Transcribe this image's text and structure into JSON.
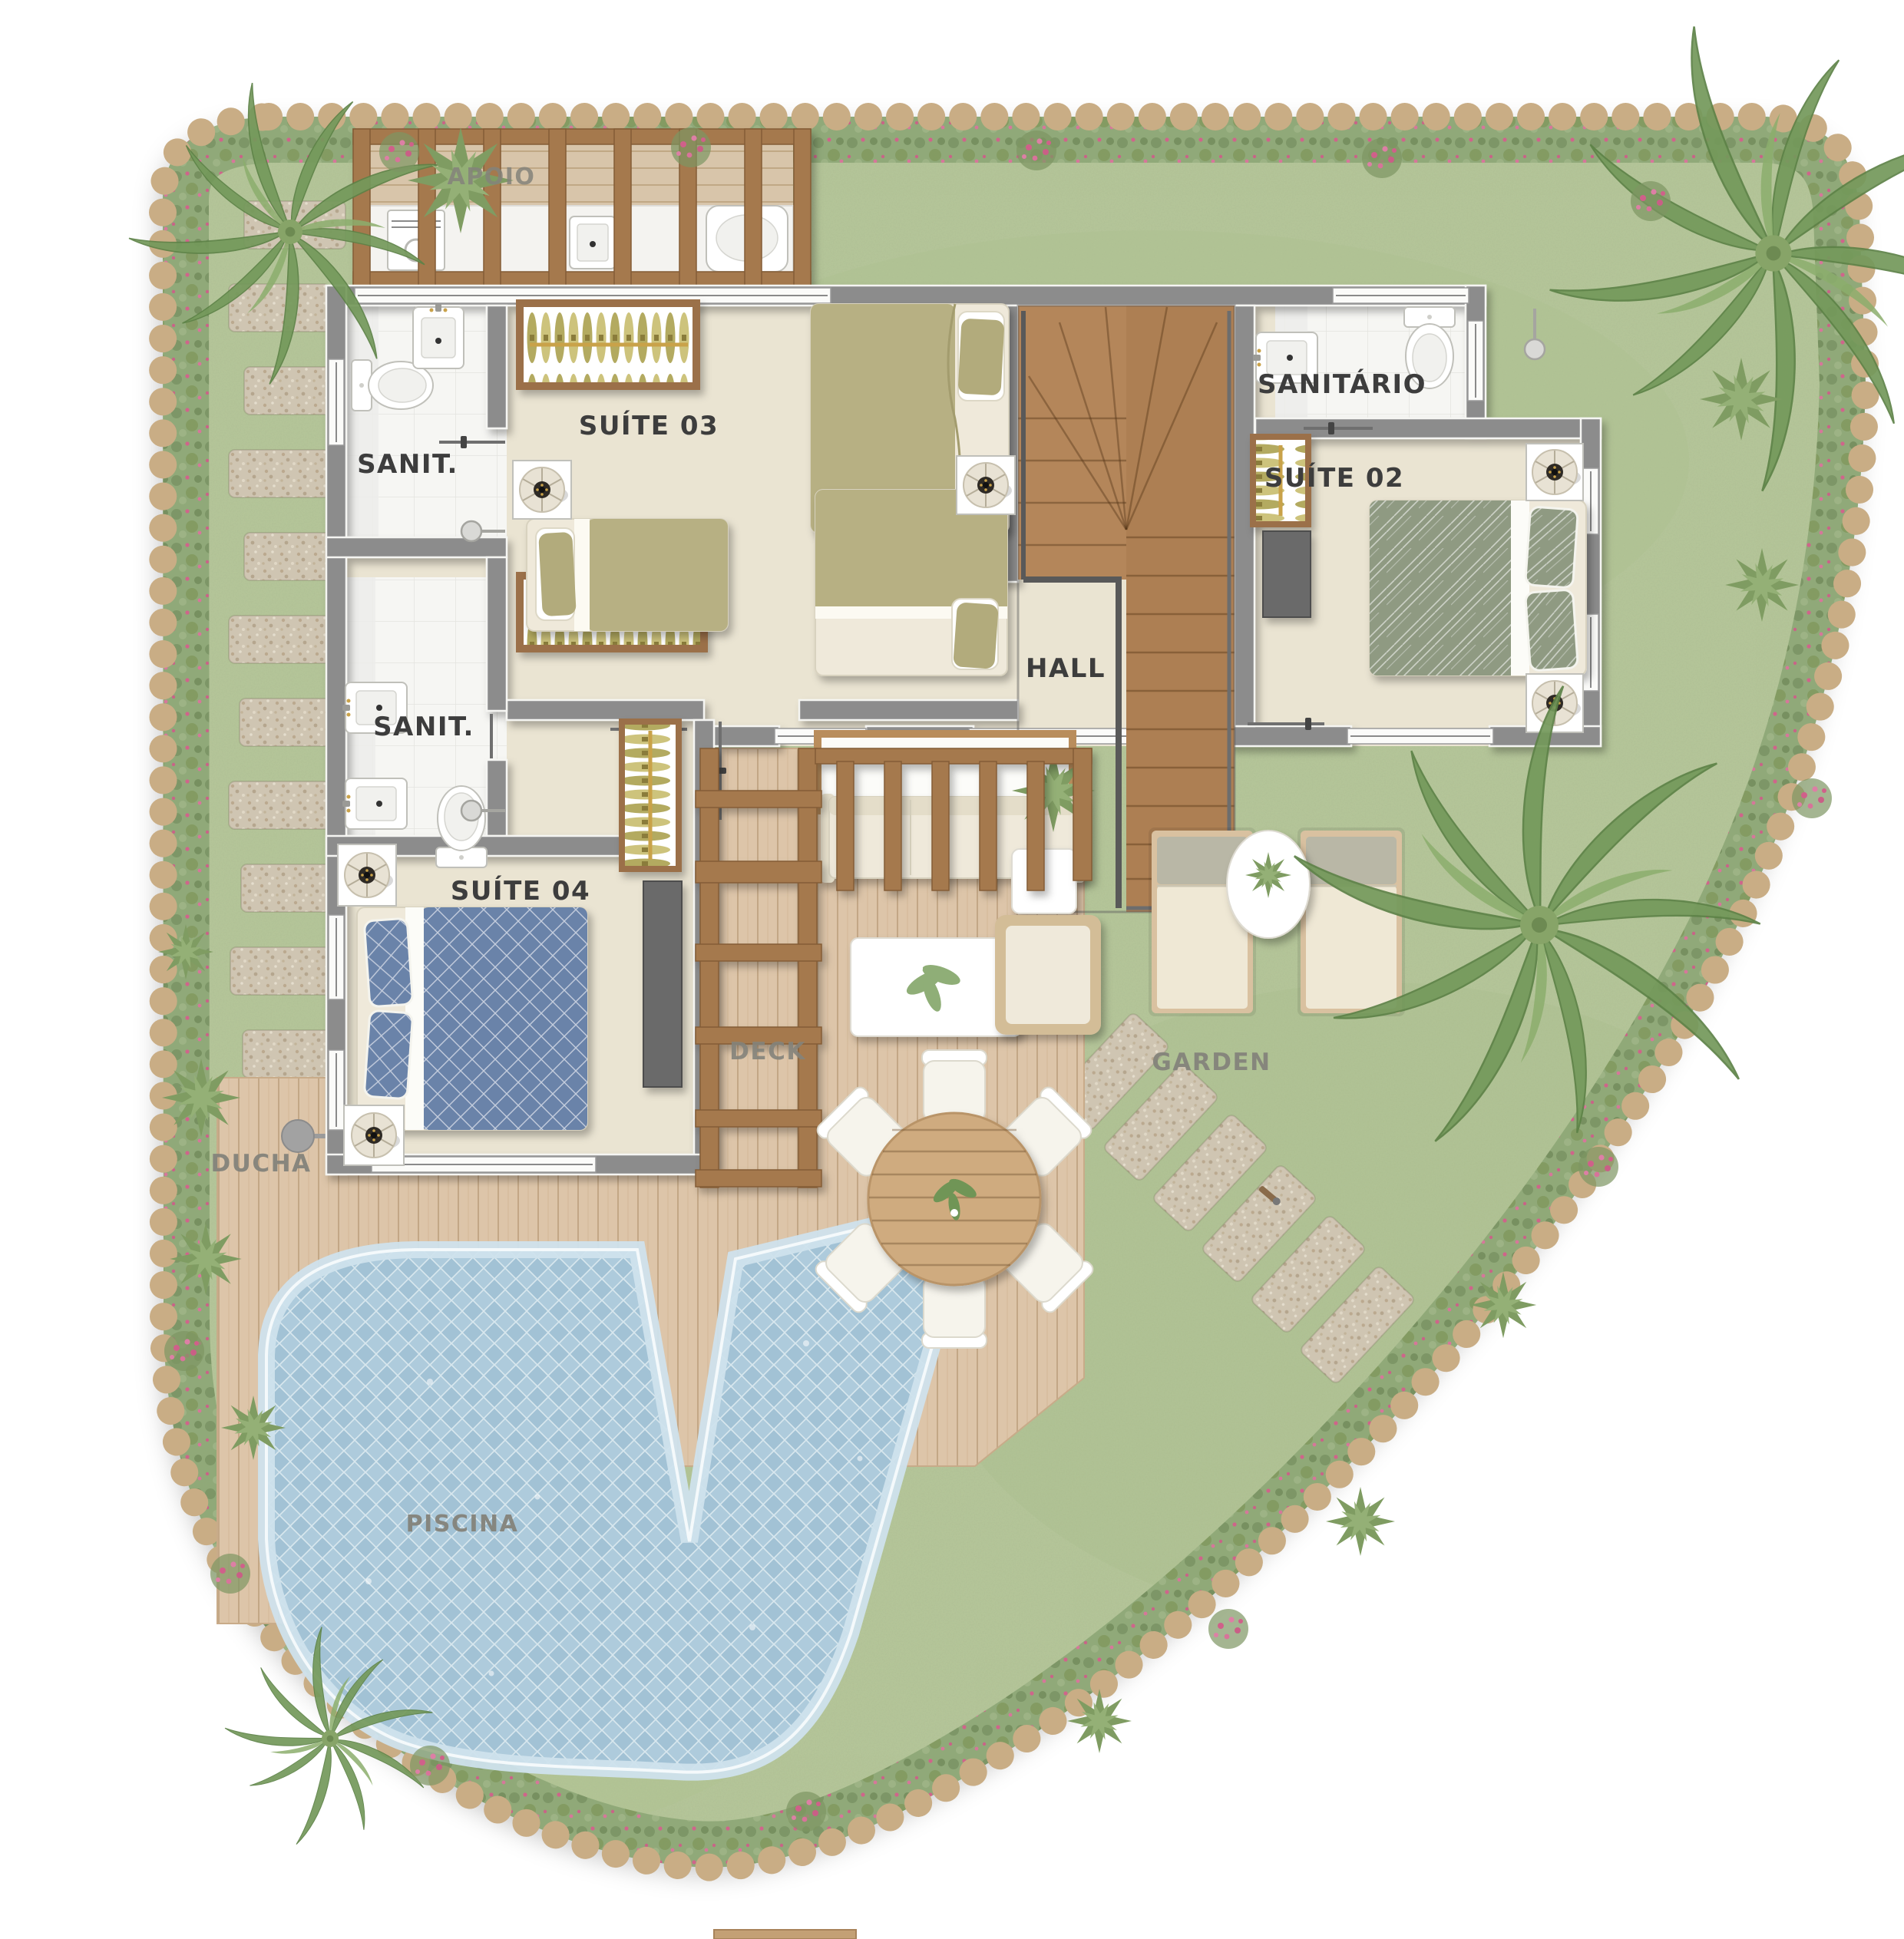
{
  "labels": {
    "apoio": "APOIO",
    "sanit_top": "SANIT.",
    "suite03": "SUÍTE 03",
    "sanitario": "SANITÁRIO",
    "suite02": "SUÍTE 02",
    "hall": "HALL",
    "sanit_bottom": "SANIT.",
    "suite04": "SUÍTE 04",
    "deck": "DECK",
    "garden": "GARDEN",
    "ducha": "DUCHA",
    "piscina": "PISCINA"
  },
  "colors": {
    "grass": "#b6c79a",
    "foliage": "#8ea877",
    "pebble": "#c9ad85",
    "flower": "#d0608a",
    "wood": "#a5794e",
    "deck": "#ddc5a9",
    "floor": "#eae4d2",
    "bathroom": "#f6f6f3",
    "wall": "#8c8c8c",
    "pool_water": "#a2c2d5",
    "pool_trim": "#cfe2ec",
    "bed_olive": "#b7b083",
    "bed_sage": "#8f9a82",
    "bed_blue": "#6b83a9",
    "stair_wood": "#b4865a",
    "label_dark": "#3d3d3d",
    "label_muted": "#84837b"
  },
  "icons": {
    "ceiling_fan": "ceiling-fan-icon",
    "toilet": "toilet-icon",
    "sink": "sink-icon",
    "shower": "shower-icon",
    "washer": "washing-machine-icon",
    "wardrobe": "wardrobe-hangers-icon",
    "stairs": "stairs-icon",
    "palm": "palm-tree-icon",
    "shrub": "shrub-icon",
    "flowers": "flower-patch-icon",
    "sun_lounger": "sun-lounger-icon",
    "dining_set": "dining-set-icon",
    "sofa": "sofa-icon",
    "outdoor_shower": "outdoor-shower-icon",
    "stepping_stone": "stepping-stone-icon"
  }
}
